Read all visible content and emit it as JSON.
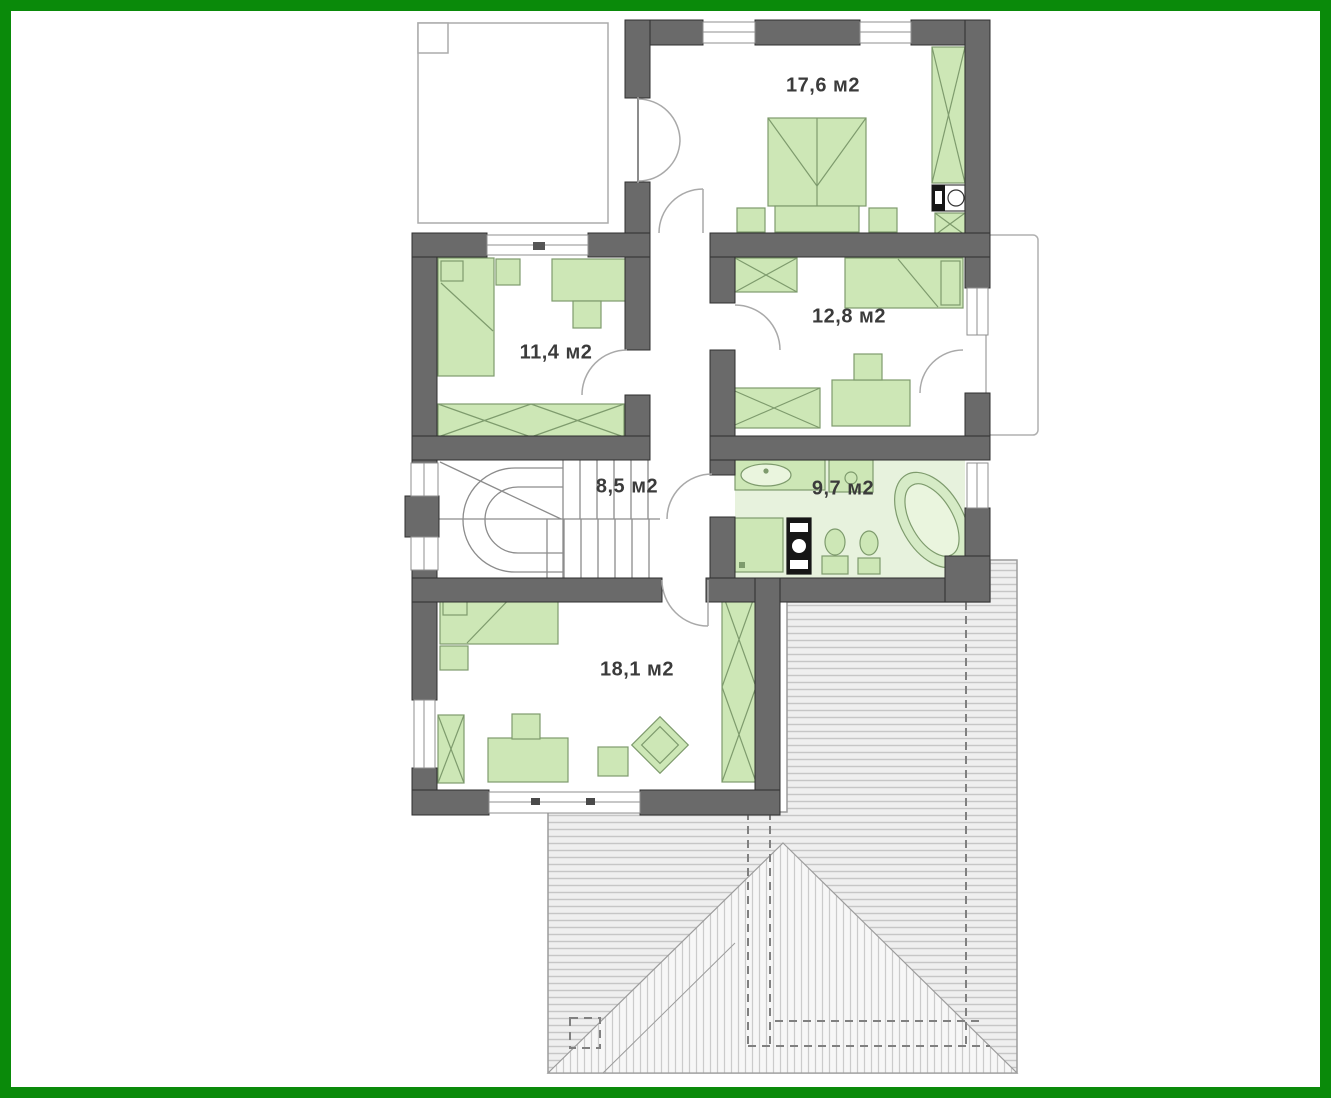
{
  "plan": {
    "type": "floor-plan",
    "rooms": [
      {
        "name": "bedroom-top",
        "area_label": "17,6 м2"
      },
      {
        "name": "bedroom-left",
        "area_label": "11,4 м2"
      },
      {
        "name": "bedroom-right",
        "area_label": "12,8 м2"
      },
      {
        "name": "hall-stairs",
        "area_label": "8,5 м2"
      },
      {
        "name": "bathroom",
        "area_label": "9,7 м2"
      },
      {
        "name": "bedroom-bottom",
        "area_label": "18,1 м2"
      }
    ],
    "colors": {
      "frame_border_green": "#0a8a0a",
      "wall_gray": "#6a6a6a",
      "wall_outline": "#2f2f2f",
      "furniture_green_fill": "#cde7b6",
      "furniture_green_stroke": "#7e9b6d",
      "bathroom_floor": "#e7f2dd",
      "roof_hatch_line": "#c6c6c6",
      "thin_outline_gray": "#ababab",
      "label_text": "#3b3b3b"
    }
  }
}
